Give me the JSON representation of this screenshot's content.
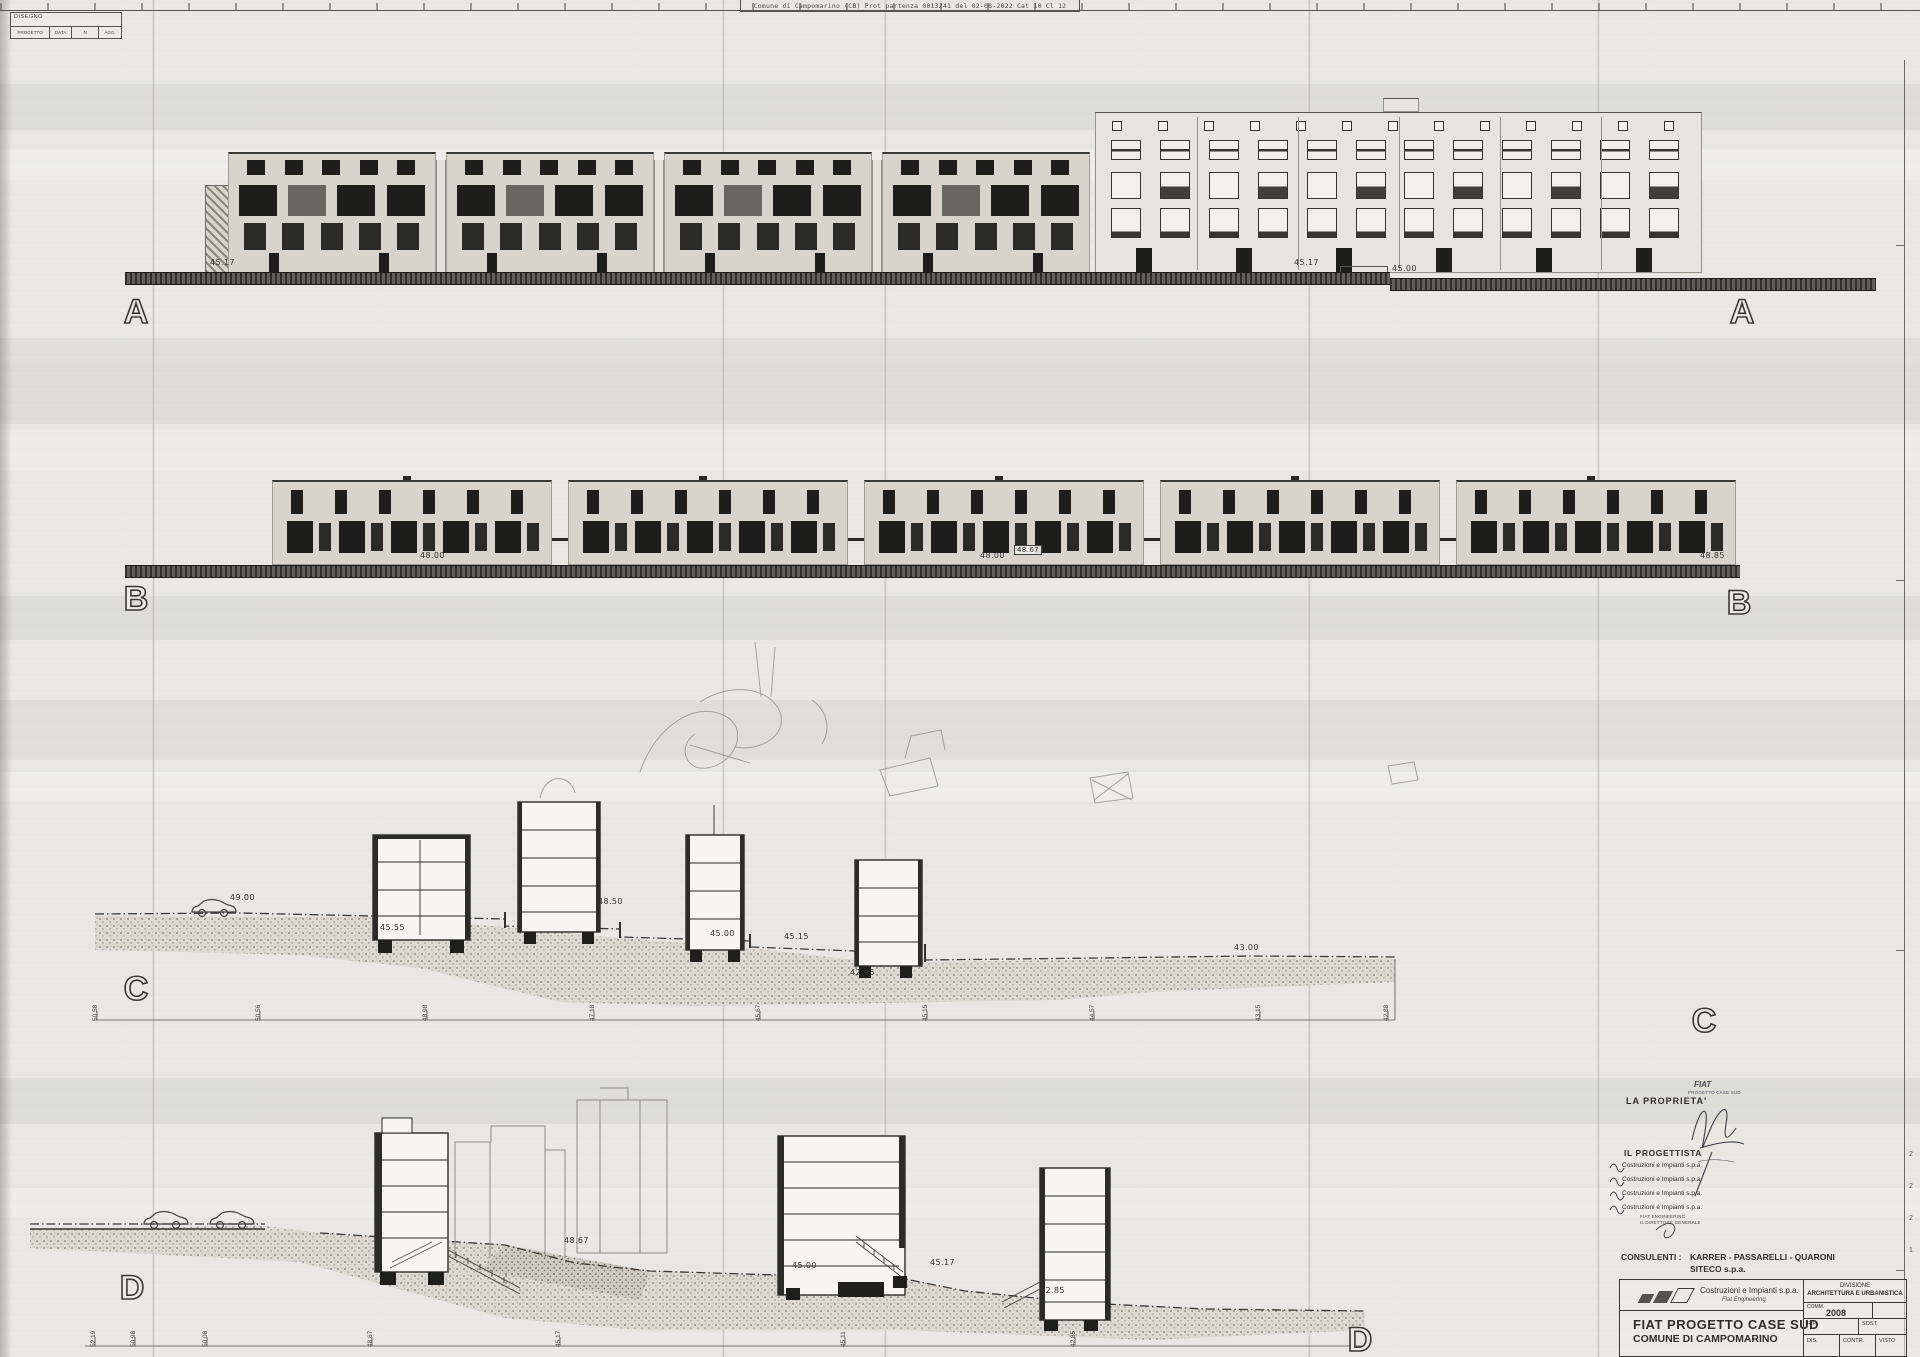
{
  "scan_header": {
    "protocol_text": "Comune di Campomarino (CB) Prot  partenza 0013241 del 02-08-2022 Cat 10 Cl 12"
  },
  "disegno_box": {
    "title": "DISEGNO",
    "col_progetto": "PROGETTO",
    "col_data": "DATA",
    "col_n": "N",
    "col_agg": "AGG."
  },
  "elevation_a": {
    "label": "A",
    "level_left": "45.17",
    "level_mid": "45.17",
    "level_right": "45.00"
  },
  "elevation_b": {
    "label": "B",
    "level_1": "48.00",
    "level_2": "48.00",
    "level_3": "48.67",
    "level_4": "48.85"
  },
  "section_c": {
    "label": "C",
    "levels": [
      "49.00",
      "48.50",
      "45.55",
      "45.00",
      "45.15",
      "42.95",
      "43.00"
    ],
    "dims": [
      "50.58",
      "50.56",
      "48.98",
      "47.18",
      "45.67",
      "45.15",
      "44.57",
      "43.15",
      "42.88"
    ]
  },
  "section_d": {
    "label": "D",
    "levels": [
      "48.67",
      "45.00",
      "45.17",
      "42.85"
    ],
    "dims": [
      "52.19",
      "50.98",
      "50.08",
      "48.67",
      "45.17",
      "45.11",
      "42.85"
    ]
  },
  "signature_area": {
    "proprieta_label": "LA  PROPRIETA'",
    "stamp_line1": "FIAT",
    "stamp_line2": "PROGETTO CASE SUD",
    "progettista_label": "IL  PROGETTISTA",
    "firm_line": "Costruzioni e Impianti s.p.a.",
    "sub_line1": "FIAT ENGINEERING",
    "sub_line2": "IL DIRETTORE GENERALE",
    "consulenti_label": "CONSULENTI :",
    "consulenti_names": "KARRER - PASSARELLI - QUARONI",
    "consulenti_firm": "SITECO  s.p.a."
  },
  "title_block": {
    "company": "Costruzioni e Impianti s.p.a.",
    "company_sub": "Fiat Engineering",
    "project_line1": "FIAT  PROGETTO  CASE  SUD",
    "project_line2": "COMUNE DI CAMPOMARINO",
    "division_line1": "DIVISIONE",
    "division_line2": "ARCHITETTURA E URBANISTICA",
    "comm_label": "COMM.",
    "comm_value": "2008",
    "rif_label": "RIF.",
    "sost_label": "SOST.",
    "dis_label": "DIS.",
    "contr_label": "CONTR.",
    "visto_label": "VISTO"
  },
  "edge_marks": {
    "m1": "2",
    "m2": "2",
    "m3": "2",
    "m4": "1"
  }
}
